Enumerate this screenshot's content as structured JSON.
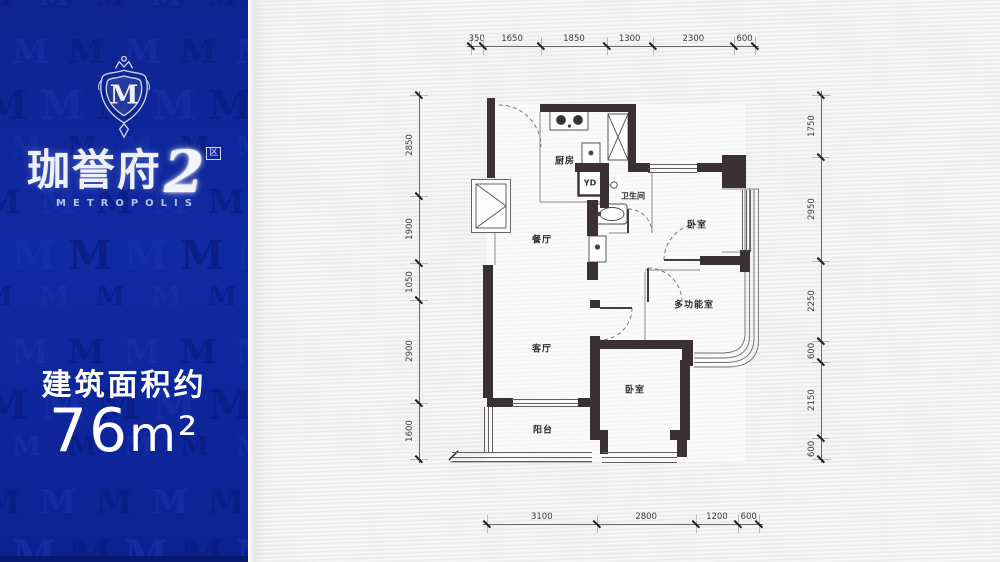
{
  "brand": {
    "monogram": "M",
    "name": "珈誉府",
    "number": "2",
    "badge": "区",
    "subtitle": "METROPOLIS"
  },
  "area": {
    "label": "建筑面积约",
    "value": "76",
    "unit": "m²"
  },
  "plan": {
    "rooms": {
      "kitchen": "厨房",
      "bath": "卫生间",
      "bedroom1": "卧室",
      "multi": "多功能室",
      "dining": "餐厅",
      "living": "客厅",
      "bedroom2": "卧室",
      "balcony": "阳台",
      "yd": "YD"
    },
    "dims": {
      "top": [
        350,
        1650,
        1850,
        1300,
        2300,
        600
      ],
      "bottom": [
        3100,
        2800,
        1200,
        600
      ],
      "left": [
        2850,
        1900,
        1050,
        2900,
        1600
      ],
      "right": [
        1750,
        2950,
        2250,
        600,
        2150,
        600
      ]
    }
  },
  "colors": {
    "panel_blue": "#0e2596",
    "panel_band": "#081a6e",
    "wall": "#3a3134",
    "paper": "#f1f1f2",
    "brand_silver": "#cfd7f0"
  }
}
